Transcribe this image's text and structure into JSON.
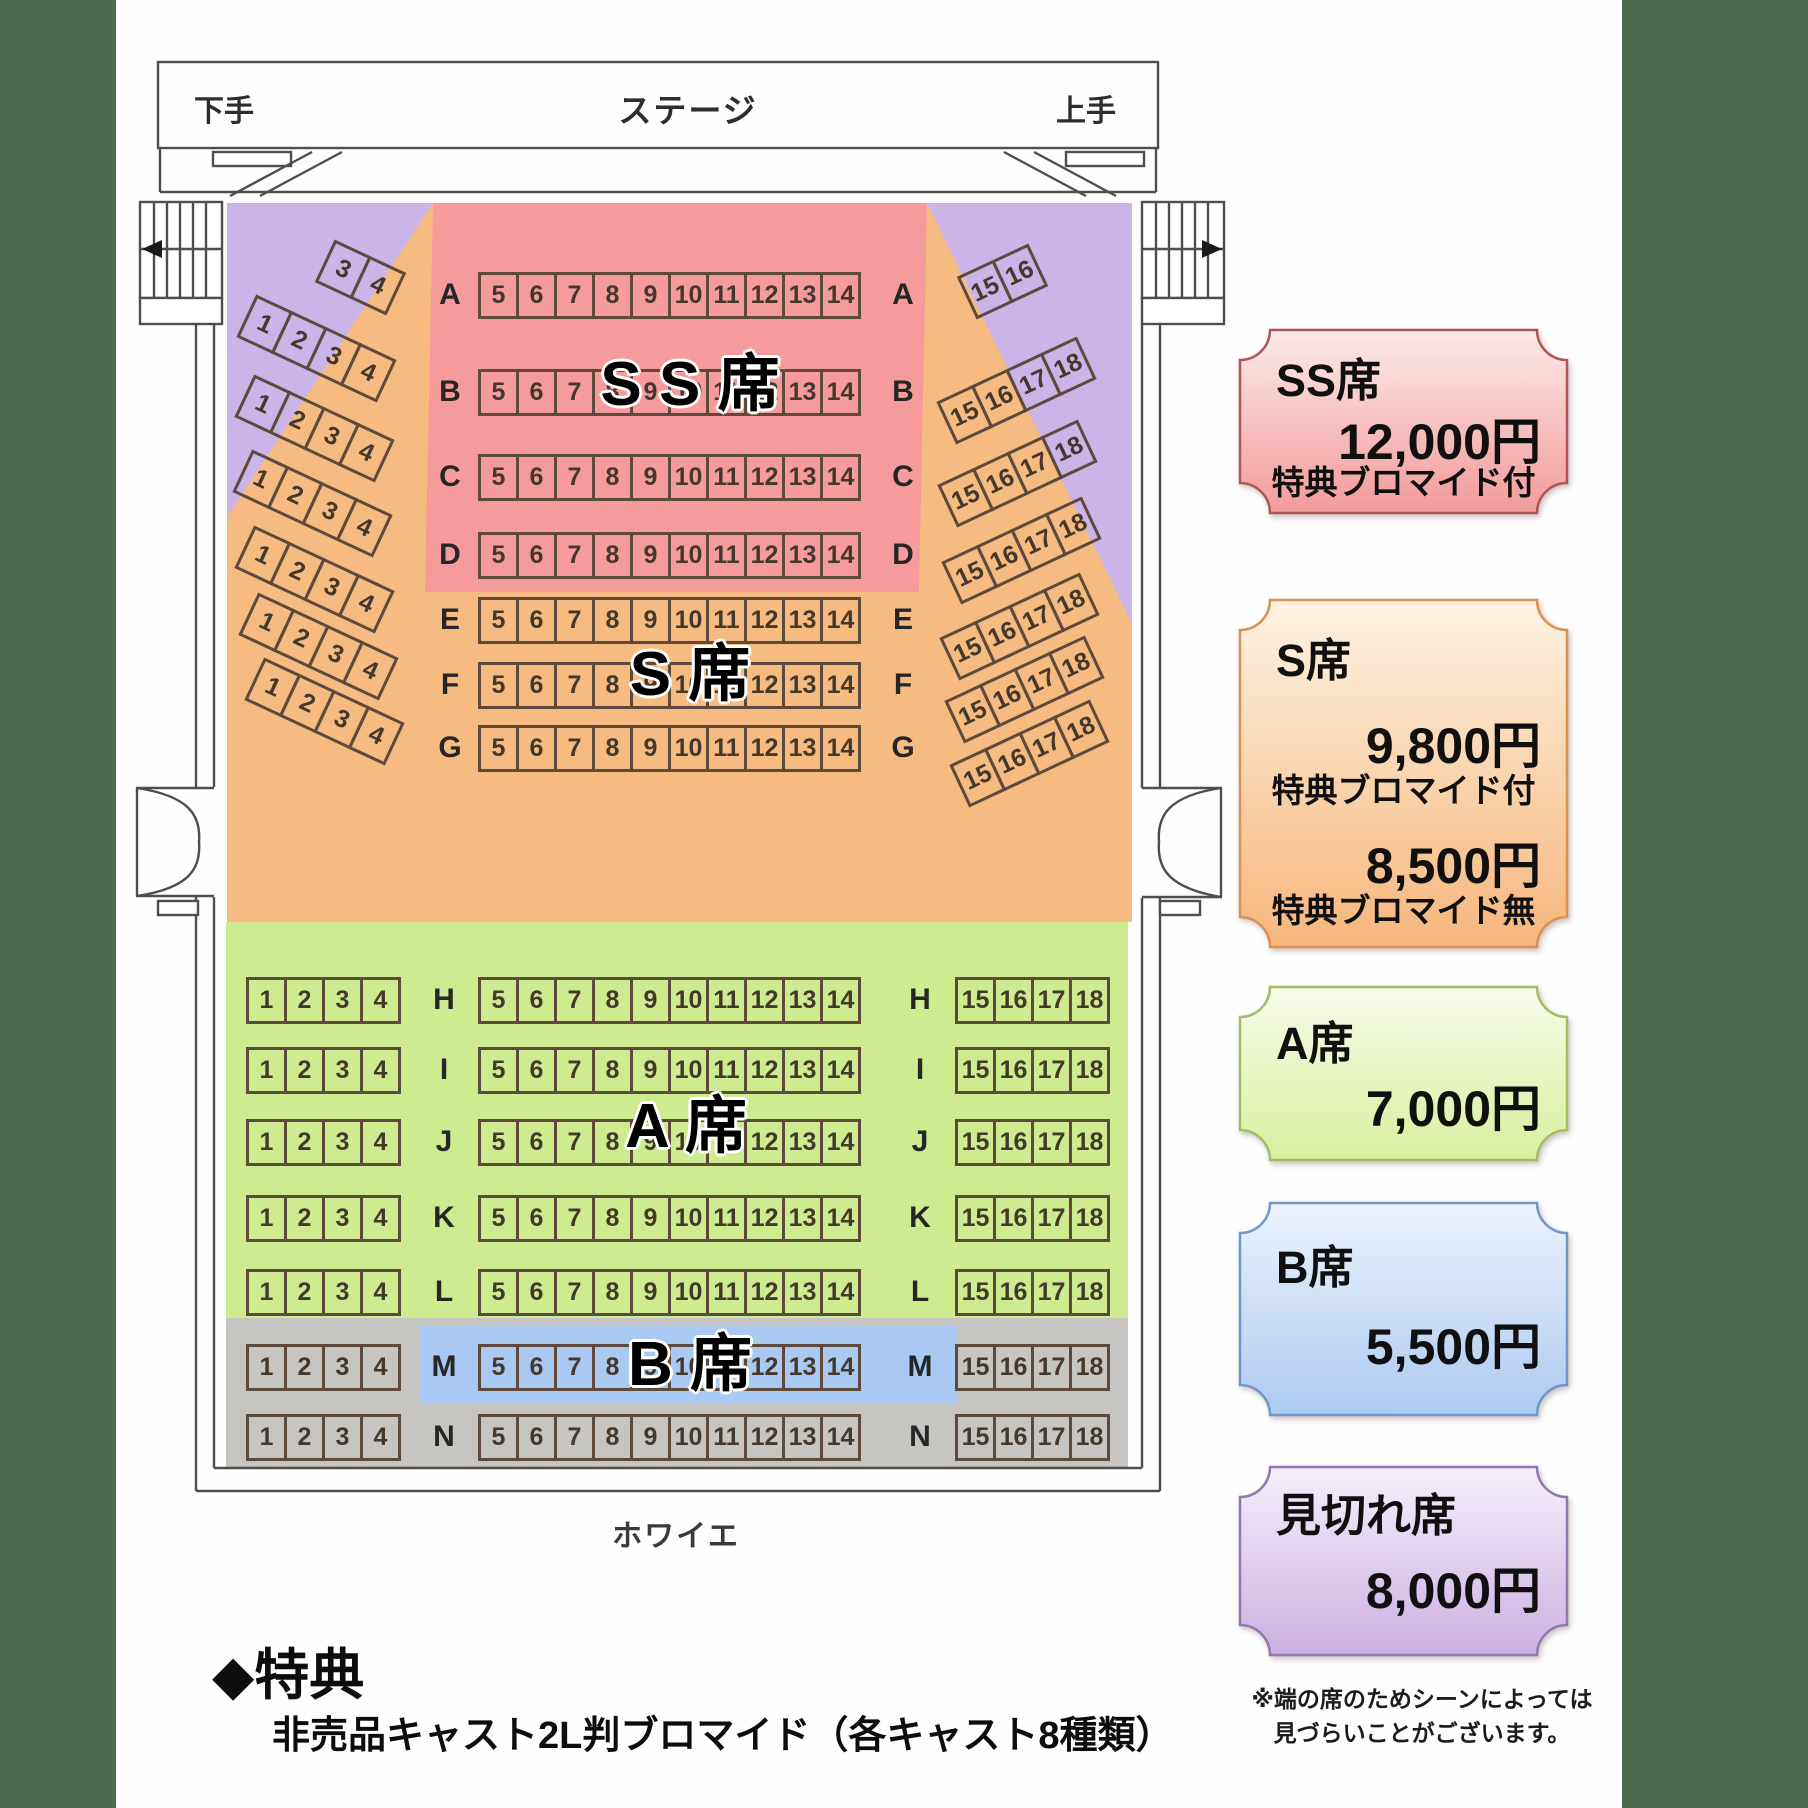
{
  "stage": {
    "left_wing": "下手",
    "label": "ステージ",
    "right_wing": "上手"
  },
  "foyer_label": "ホワイエ",
  "zone_labels": {
    "ss": "S S 席",
    "s": "S 席",
    "a": "A 席",
    "b": "B 席"
  },
  "rows": [
    {
      "letter": "A",
      "left": [
        "3",
        "4"
      ],
      "center": [
        "5",
        "6",
        "7",
        "8",
        "9",
        "10",
        "11",
        "12",
        "13",
        "14"
      ],
      "right": [
        "15",
        "16"
      ]
    },
    {
      "letter": "B",
      "left": [
        "1",
        "2",
        "3",
        "4"
      ],
      "center": [
        "5",
        "6",
        "7",
        "8",
        "9",
        "10",
        "11",
        "12",
        "13",
        "14"
      ],
      "right": [
        "15",
        "16",
        "17",
        "18"
      ]
    },
    {
      "letter": "C",
      "left": [
        "1",
        "2",
        "3",
        "4"
      ],
      "center": [
        "5",
        "6",
        "7",
        "8",
        "9",
        "10",
        "11",
        "12",
        "13",
        "14"
      ],
      "right": [
        "15",
        "16",
        "17",
        "18"
      ]
    },
    {
      "letter": "D",
      "left": [
        "1",
        "2",
        "3",
        "4"
      ],
      "center": [
        "5",
        "6",
        "7",
        "8",
        "9",
        "10",
        "11",
        "12",
        "13",
        "14"
      ],
      "right": [
        "15",
        "16",
        "17",
        "18"
      ]
    },
    {
      "letter": "E",
      "left": [
        "1",
        "2",
        "3",
        "4"
      ],
      "center": [
        "5",
        "6",
        "7",
        "8",
        "9",
        "10",
        "11",
        "12",
        "13",
        "14"
      ],
      "right": [
        "15",
        "16",
        "17",
        "18"
      ]
    },
    {
      "letter": "F",
      "left": [
        "1",
        "2",
        "3",
        "4"
      ],
      "center": [
        "5",
        "6",
        "7",
        "8",
        "9",
        "10",
        "11",
        "12",
        "13",
        "14"
      ],
      "right": [
        "15",
        "16",
        "17",
        "18"
      ]
    },
    {
      "letter": "G",
      "left": [
        "1",
        "2",
        "3",
        "4"
      ],
      "center": [
        "5",
        "6",
        "7",
        "8",
        "9",
        "10",
        "11",
        "12",
        "13",
        "14"
      ],
      "right": [
        "15",
        "16",
        "17",
        "18"
      ]
    },
    {
      "letter": "H",
      "left": [
        "1",
        "2",
        "3",
        "4"
      ],
      "center": [
        "5",
        "6",
        "7",
        "8",
        "9",
        "10",
        "11",
        "12",
        "13",
        "14"
      ],
      "right": [
        "15",
        "16",
        "17",
        "18"
      ]
    },
    {
      "letter": "I",
      "left": [
        "1",
        "2",
        "3",
        "4"
      ],
      "center": [
        "5",
        "6",
        "7",
        "8",
        "9",
        "10",
        "11",
        "12",
        "13",
        "14"
      ],
      "right": [
        "15",
        "16",
        "17",
        "18"
      ]
    },
    {
      "letter": "J",
      "left": [
        "1",
        "2",
        "3",
        "4"
      ],
      "center": [
        "5",
        "6",
        "7",
        "8",
        "9",
        "10",
        "11",
        "12",
        "13",
        "14"
      ],
      "right": [
        "15",
        "16",
        "17",
        "18"
      ]
    },
    {
      "letter": "K",
      "left": [
        "1",
        "2",
        "3",
        "4"
      ],
      "center": [
        "5",
        "6",
        "7",
        "8",
        "9",
        "10",
        "11",
        "12",
        "13",
        "14"
      ],
      "right": [
        "15",
        "16",
        "17",
        "18"
      ]
    },
    {
      "letter": "L",
      "left": [
        "1",
        "2",
        "3",
        "4"
      ],
      "center": [
        "5",
        "6",
        "7",
        "8",
        "9",
        "10",
        "11",
        "12",
        "13",
        "14"
      ],
      "right": [
        "15",
        "16",
        "17",
        "18"
      ]
    },
    {
      "letter": "M",
      "left": [
        "1",
        "2",
        "3",
        "4"
      ],
      "center": [
        "5",
        "6",
        "7",
        "8",
        "9",
        "10",
        "11",
        "12",
        "13",
        "14"
      ],
      "right": [
        "15",
        "16",
        "17",
        "18"
      ]
    },
    {
      "letter": "N",
      "left": [
        "1",
        "2",
        "3",
        "4"
      ],
      "center": [
        "5",
        "6",
        "7",
        "8",
        "9",
        "10",
        "11",
        "12",
        "13",
        "14"
      ],
      "right": [
        "15",
        "16",
        "17",
        "18"
      ]
    }
  ],
  "legend": {
    "items": [
      {
        "id": "ss",
        "name": "SS席",
        "price": "12,000円",
        "note": "特典ブロマイド付"
      },
      {
        "id": "s",
        "name": "S席",
        "price": "9,800円",
        "note": "特典ブロマイド付",
        "price2": "8,500円",
        "note2": "特典ブロマイド無"
      },
      {
        "id": "a",
        "name": "A席",
        "price": "7,000円"
      },
      {
        "id": "b",
        "name": "B席",
        "price": "5,500円"
      },
      {
        "id": "m",
        "name": "見切れ席",
        "price": "8,000円"
      }
    ],
    "footnote_lines": [
      "※端の席のためシーンによっては",
      "見づらいことがございます。"
    ]
  },
  "benefits": {
    "heading": "◆特典",
    "body": "非売品キャスト2L判ブロマイド（各キャスト8種類）"
  },
  "colors": {
    "zone_purple": "#cbb4e8",
    "zone_pink": "#f69b9c",
    "zone_orange": "#f6bb80",
    "zone_green": "#cfeb8f",
    "zone_blue": "#a9c9f2",
    "zone_gray": "#c6c5c1",
    "margin_band": "#4d6b4e",
    "wall_line": "#4e4e4c",
    "tickets": {
      "ss": {
        "top": "#fcebea",
        "bottom": "#f29a9a",
        "border": "#b25454"
      },
      "s": {
        "top": "#fdf3e3",
        "bottom": "#f6b67c",
        "border": "#dc9150"
      },
      "a": {
        "top": "#f7fbe9",
        "bottom": "#d9ef9f",
        "border": "#a2bf66"
      },
      "b": {
        "top": "#edf3fc",
        "bottom": "#accaf1",
        "border": "#7396ca"
      },
      "m": {
        "top": "#f5effa",
        "bottom": "#cbb0e2",
        "border": "#9378b0"
      }
    }
  }
}
